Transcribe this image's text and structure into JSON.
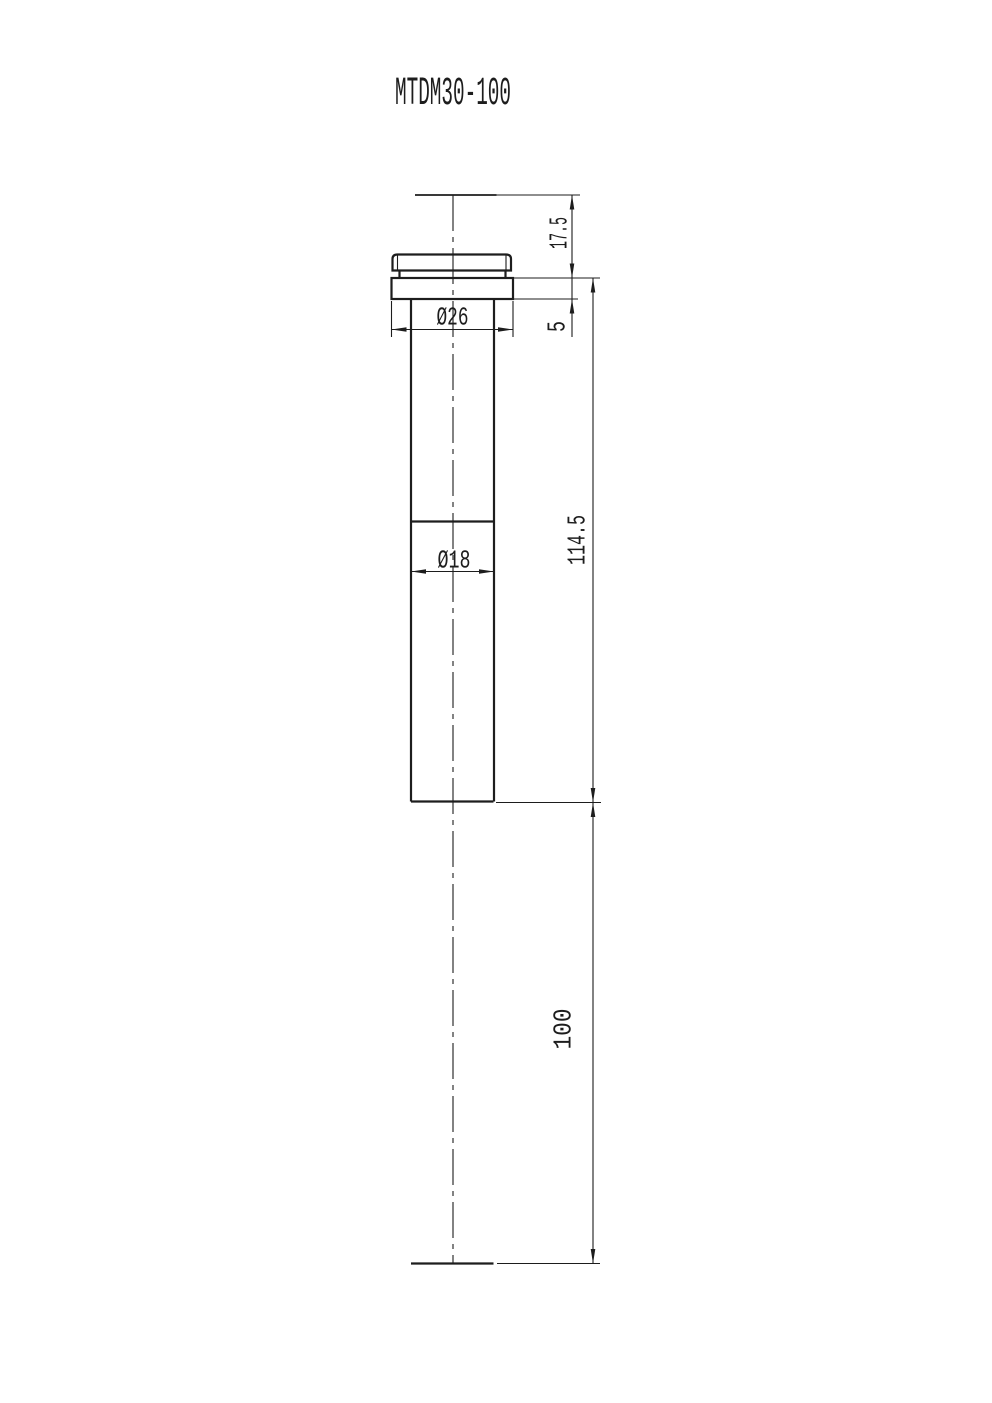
{
  "title": "MTDM30-100",
  "drawing": {
    "dim_top_to_flange_height": "17.5",
    "dim_flange_thickness": "5",
    "dim_flange_diameter": "Ø26",
    "dim_body_diameter": "Ø18",
    "dim_body_length": "114.5",
    "dim_working_distance": "100"
  },
  "colors": {
    "line": "#1d1d1d",
    "background": "#ffffff"
  }
}
